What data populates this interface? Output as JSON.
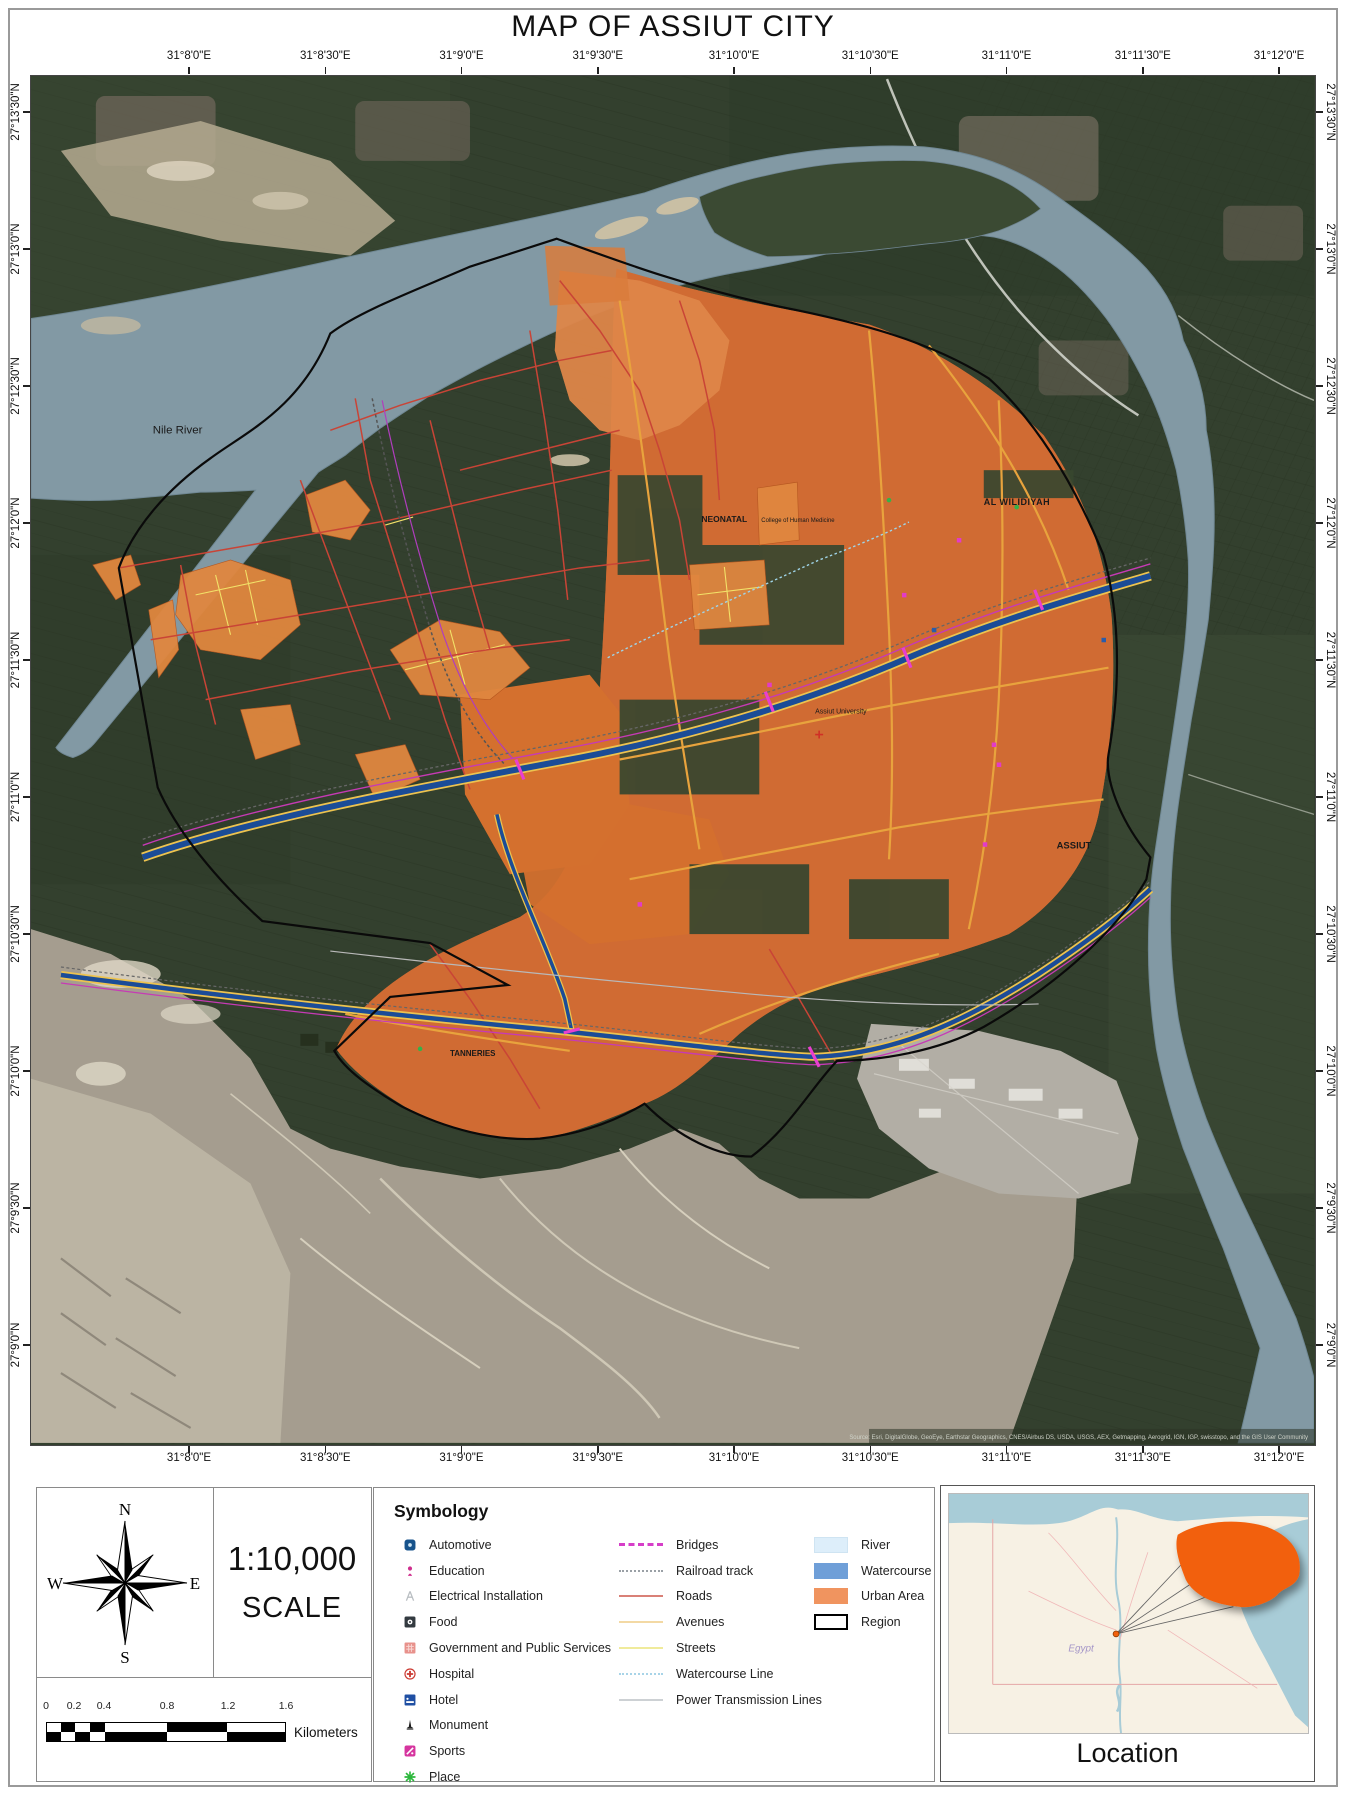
{
  "title": "MAP OF ASSIUT CITY",
  "map": {
    "top_coordinates": [
      "31°8'0\"E",
      "31°8'30\"E",
      "31°9'0\"E",
      "31°9'30\"E",
      "31°10'0\"E",
      "31°10'30\"E",
      "31°11'0\"E",
      "31°11'30\"E",
      "31°12'0\"E"
    ],
    "bottom_coordinates": [
      "31°8'0\"E",
      "31°8'30\"E",
      "31°9'0\"E",
      "31°9'30\"E",
      "31°10'0\"E",
      "31°10'30\"E",
      "31°11'0\"E",
      "31°11'30\"E",
      "31°12'0\"E"
    ],
    "left_coordinates": [
      "27°13'30\"N",
      "27°13'0\"N",
      "27°12'30\"N",
      "27°12'0\"N",
      "27°11'30\"N",
      "27°11'0\"N",
      "27°10'30\"N",
      "27°10'0\"N",
      "27°9'30\"N",
      "27°9'0\"N"
    ],
    "right_coordinates": [
      "27°13'30\"N",
      "27°13'0\"N",
      "27°12'30\"N",
      "27°12'0\"N",
      "27°11'30\"N",
      "27°11'0\"N",
      "27°10'30\"N",
      "27°10'0\"N",
      "27°9'30\"N",
      "27°9'0\"N"
    ],
    "labels": {
      "river": "Nile River",
      "district_ne": "AL WILIDIYAH",
      "district_nw": "NEONATAL",
      "college": "College of Human Medicine",
      "university": "Assiut University",
      "city": "ASSIUT",
      "district_sw": "TANNERIES"
    },
    "attribution": "Source: Esri, DigitalGlobe, GeoEye, Earthstar Geographics, CNES/Airbus DS, USDA, USGS, AEX, Getmapping, Aerogrid, IGN, IGP, swisstopo, and the GIS User Community"
  },
  "panel": {
    "compass": {
      "north": "N",
      "east": "E",
      "south": "S",
      "west": "W"
    },
    "scale": {
      "ratio": "1:10,000",
      "label": "SCALE"
    },
    "scalebar": {
      "tick_labels": [
        "0",
        "0.2",
        "0.4",
        "0.8",
        "1.2",
        "1.6"
      ],
      "unit": "Kilometers"
    },
    "symbology": {
      "heading": "Symbology",
      "point_items": [
        {
          "label": "Automotive",
          "icon": "automotive-icon",
          "color": "#17538c"
        },
        {
          "label": "Education",
          "icon": "education-icon",
          "color": "#cf2f8e"
        },
        {
          "label": "Electrical Installation",
          "icon": "electrical-installation-icon",
          "color": "#b9bec2"
        },
        {
          "label": "Food",
          "icon": "food-icon",
          "color": "#333a40"
        },
        {
          "label": "Government and Public Services",
          "icon": "government-icon",
          "color": "#e8928c"
        },
        {
          "label": "Hospital",
          "icon": "hospital-icon",
          "color": "#cc3b33"
        },
        {
          "label": "Hotel",
          "icon": "hotel-icon",
          "color": "#1f4fa3"
        },
        {
          "label": "Monument",
          "icon": "monument-icon",
          "color": "#1a1a1a"
        },
        {
          "label": "Sports",
          "icon": "sports-icon",
          "color": "#d6359f"
        },
        {
          "label": "Place",
          "icon": "place-icon",
          "color": "#2db83d"
        }
      ],
      "line_items": [
        {
          "label": "Bridges",
          "style": "bridges",
          "color": "#d63ec8"
        },
        {
          "label": "Railroad track",
          "style": "railroad",
          "color": "#9aa0a6"
        },
        {
          "label": "Roads",
          "style": "roads",
          "color": "#d98077"
        },
        {
          "label": "Avenues",
          "style": "avenues",
          "color": "#f3d9a4"
        },
        {
          "label": "Streets",
          "style": "streets",
          "color": "#f0eb9b"
        },
        {
          "label": "Watercourse Line",
          "style": "watercourse-line",
          "color": "#a8d4e8"
        },
        {
          "label": "Power Transmission Lines",
          "style": "power-lines",
          "color": "#cdd1d4"
        }
      ],
      "area_items": [
        {
          "label": "River",
          "fill": "#ddeefa",
          "border": "#cfe4f2"
        },
        {
          "label": "Watercourse",
          "fill": "#6f9fd8",
          "border": "#6f9fd8"
        },
        {
          "label": "Urban Area",
          "fill": "#f0945f",
          "border": "#f0945f"
        },
        {
          "label": "Region",
          "fill": "#ffffff",
          "border": "#000000"
        }
      ]
    },
    "location": {
      "label": "Location",
      "country": "Egypt"
    }
  }
}
